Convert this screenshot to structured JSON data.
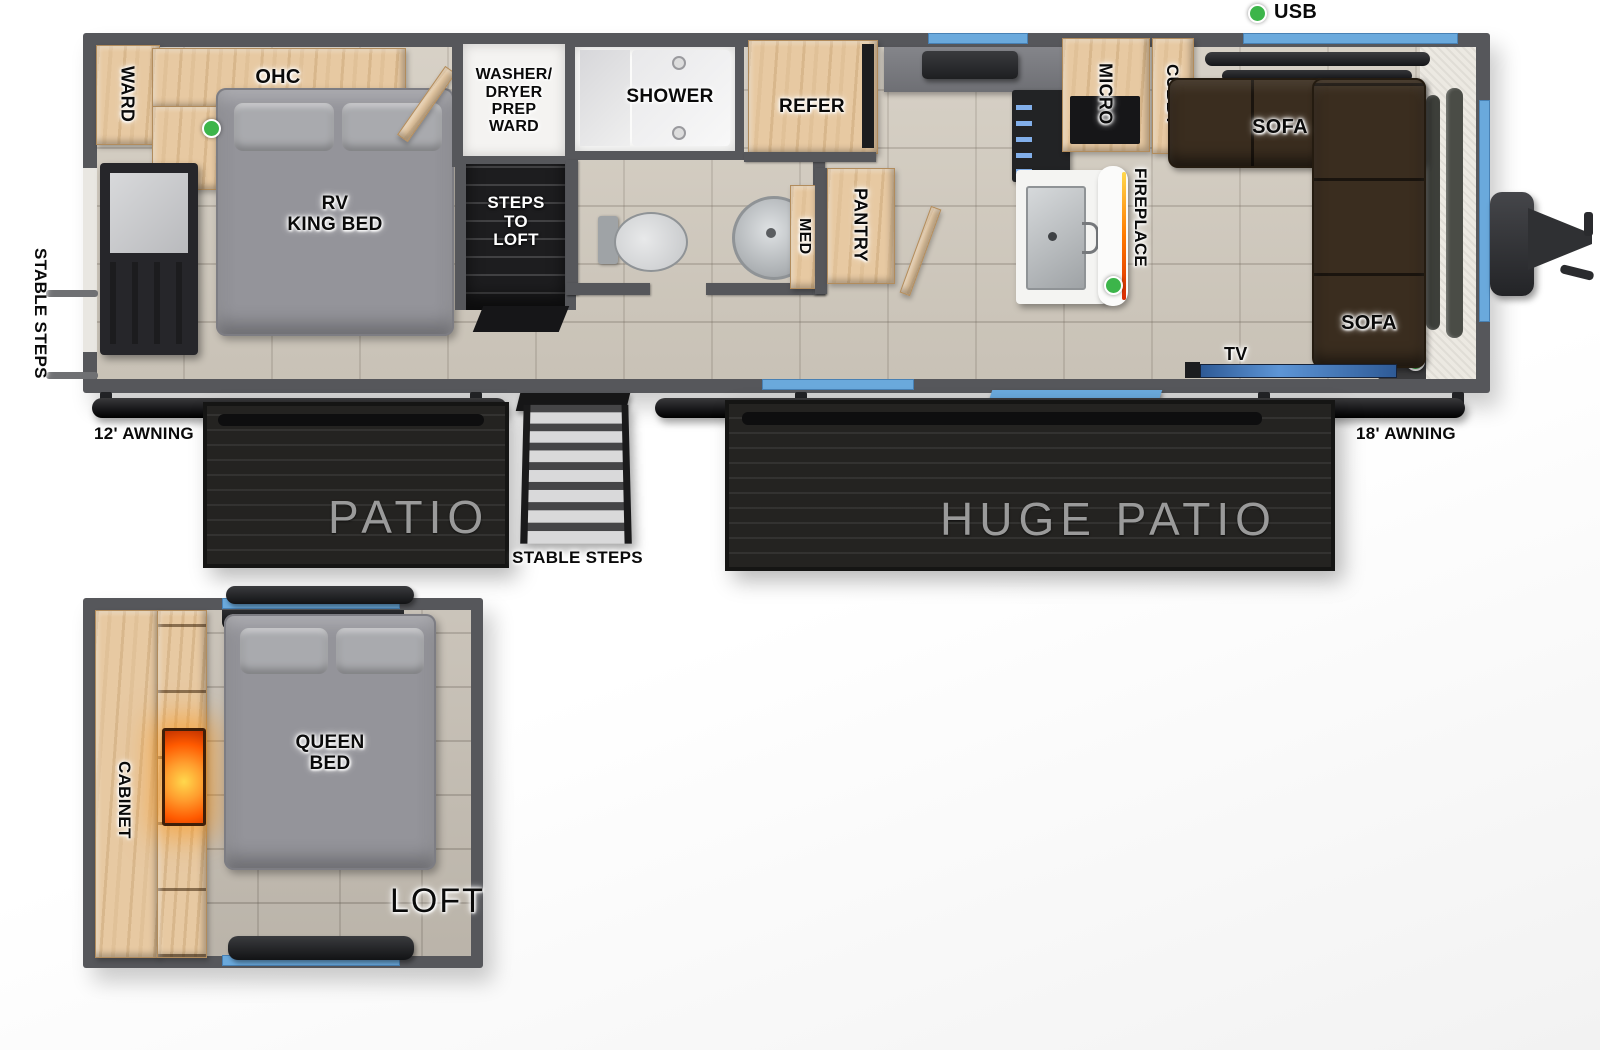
{
  "colors": {
    "wall_gray": "#56575b",
    "accent_blue": "#6aa9dc",
    "indicator_green": "#3cb54a",
    "wood": "#e7c9a2",
    "sofa_brown": "#3a2d1f",
    "patio_dark": "#242321",
    "fireplace_glow": "#ff7a00"
  },
  "main_floor": {
    "bedroom": {
      "ward_label": "WARD",
      "ohc_label": "OHC",
      "bed_label_lines": [
        "RV",
        "KING BED"
      ]
    },
    "utility": {
      "washer_label_lines": [
        "WASHER/",
        "DRYER",
        "PREP",
        "WARD"
      ],
      "steps_label_lines": [
        "STEPS",
        "TO",
        "LOFT"
      ]
    },
    "bathroom": {
      "shower_label": "SHOWER",
      "med_label": "MED"
    },
    "kitchen": {
      "refer_label": "REFER",
      "pantry_label": "PANTRY",
      "micro_label": "MICRO",
      "cubby_label": "CUBBY",
      "fireplace_label": "FIREPLACE"
    },
    "living": {
      "sofa_top_label": "SOFA",
      "sofa_right_label": "SOFA",
      "tv_label": "TV",
      "usb_label": "USB"
    }
  },
  "exterior": {
    "stable_steps_left_label": "STABLE STEPS",
    "stable_steps_center_label": "STABLE STEPS",
    "awning_left_label": "12' AWNING",
    "awning_right_label": "18' AWNING",
    "patio_label": "PATIO",
    "huge_patio_label": "HUGE PATIO"
  },
  "loft": {
    "cabinet_label": "CABINET",
    "bed_label_lines": [
      "QUEEN",
      "BED"
    ],
    "loft_label": "LOFT"
  }
}
